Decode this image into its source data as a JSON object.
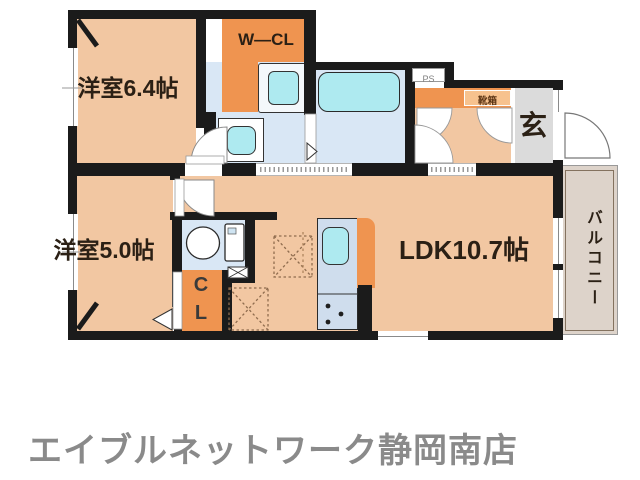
{
  "labels": {
    "room_6_4": "洋室6.4帖",
    "room_5_0": "洋室5.0帖",
    "ldk": "LDK10.7帖",
    "wcl": "W—CL",
    "cl": "C\nL",
    "genkan": "玄",
    "balcony": "バルコニー",
    "shoebox": "靴箱",
    "ps": "PS"
  },
  "rooms": [
    {
      "name": "洋室",
      "size": "6.4帖"
    },
    {
      "name": "洋室",
      "size": "5.0帖"
    },
    {
      "name": "LDK",
      "size": "10.7帖"
    },
    {
      "name": "バルコニー",
      "size": ""
    }
  ],
  "footer": {
    "agency": "エイブルネットワーク静岡南店"
  },
  "colors": {
    "room_floor": "#f2c7a2",
    "closet_orange": "#ef9450",
    "wet_area_floor": "#d9e7f5",
    "fixture_cyan": "#aeeaf0",
    "kitchen_counter": "#cfdded",
    "entrance_gray": "#dbdbdb",
    "balcony_fill": "#ddd3ca",
    "wall_black": "#1b1b1b",
    "agency_text_gray": "#8a8a8a"
  }
}
